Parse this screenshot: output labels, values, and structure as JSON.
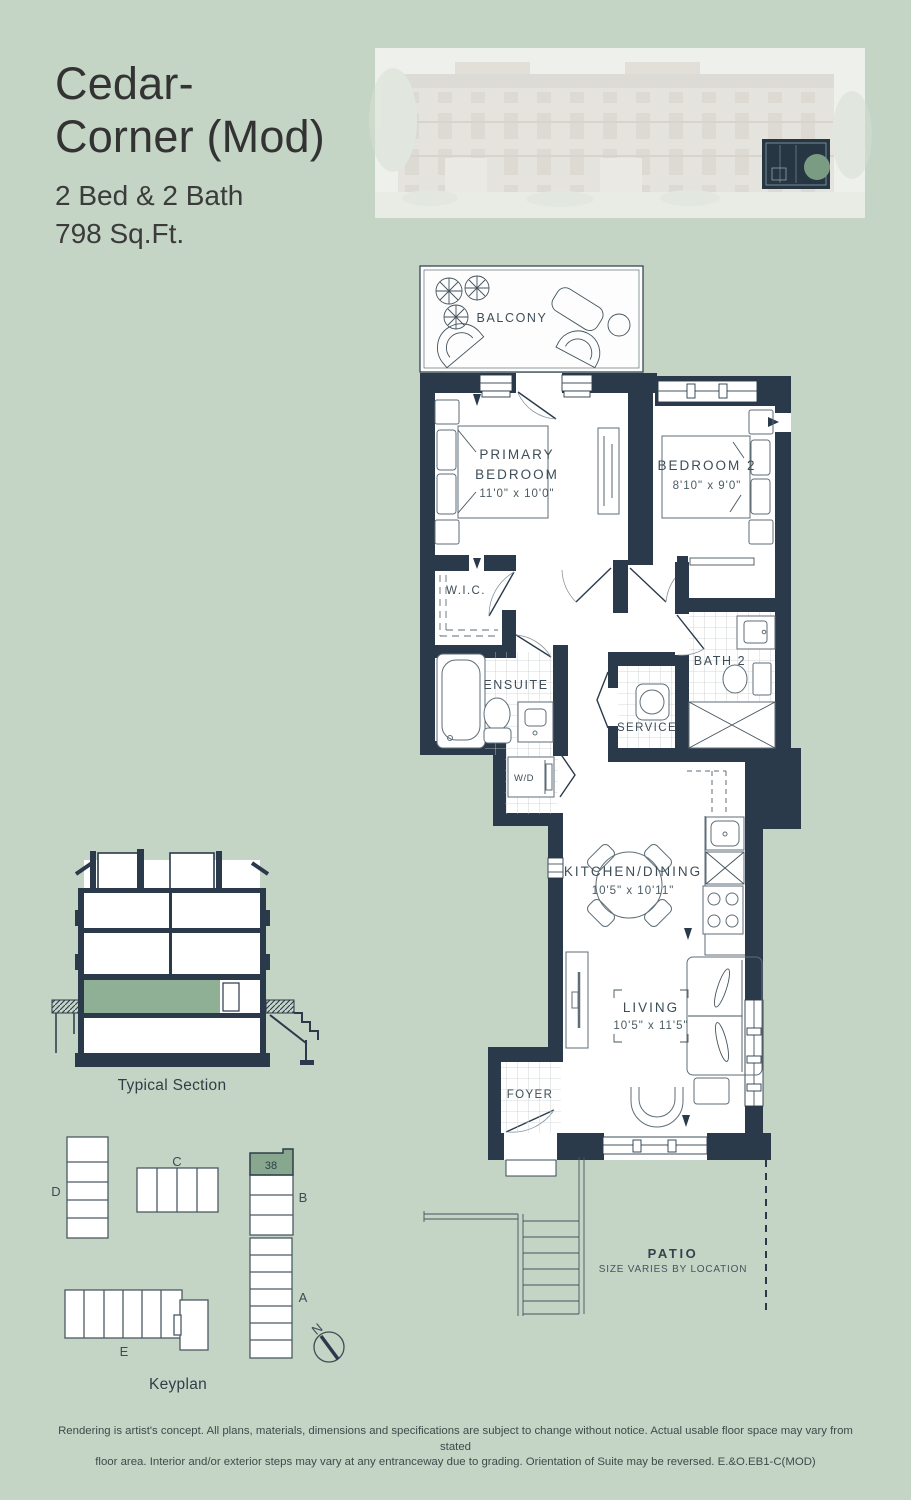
{
  "palette": {
    "background": "#c4d4c5",
    "wall": "#2a3a4a",
    "section_highlight": "#8fb095",
    "keyplan_highlight": "#87a88e"
  },
  "header": {
    "title_line1": "Cedar-",
    "title_line2": "Corner (Mod)",
    "spec_line1": "2 Bed & 2 Bath",
    "spec_line2": "798 Sq.Ft."
  },
  "floorplan": {
    "balcony": "BALCONY",
    "primary_line1": "PRIMARY",
    "primary_line2": "BEDROOM",
    "primary_dims": "11'0\" x 10'0\"",
    "bedroom2": "BEDROOM 2",
    "bedroom2_dims": "8'10\" x 9'0\"",
    "wic": "W.I.C.",
    "ensuite": "ENSUITE",
    "bath2": "BATH 2",
    "service": "SERVICE",
    "wd": "W/D",
    "kitchen": "KITCHEN/DINING",
    "kitchen_dims": "10'5\" x 10'11\"",
    "living": "LIVING",
    "living_dims": "10'5\" x 11'5\"",
    "foyer": "FOYER",
    "patio": "PATIO",
    "patio_note": "SIZE VARIES BY LOCATION"
  },
  "section_label": "Typical Section",
  "keyplan": {
    "label": "Keyplan",
    "unit": "38",
    "bldg_a": "A",
    "bldg_b": "B",
    "bldg_c": "C",
    "bldg_d": "D",
    "bldg_e": "E",
    "north": "N"
  },
  "disclaimer": {
    "line1": "Rendering is artist's concept. All plans, materials, dimensions and specifications are subject to change without notice. Actual usable floor space may vary from stated",
    "line2": "floor area. Interior and/or exterior steps may vary at any entranceway due to grading. Orientation of Suite may be reversed. E.&O.EB1-C(MOD)"
  }
}
